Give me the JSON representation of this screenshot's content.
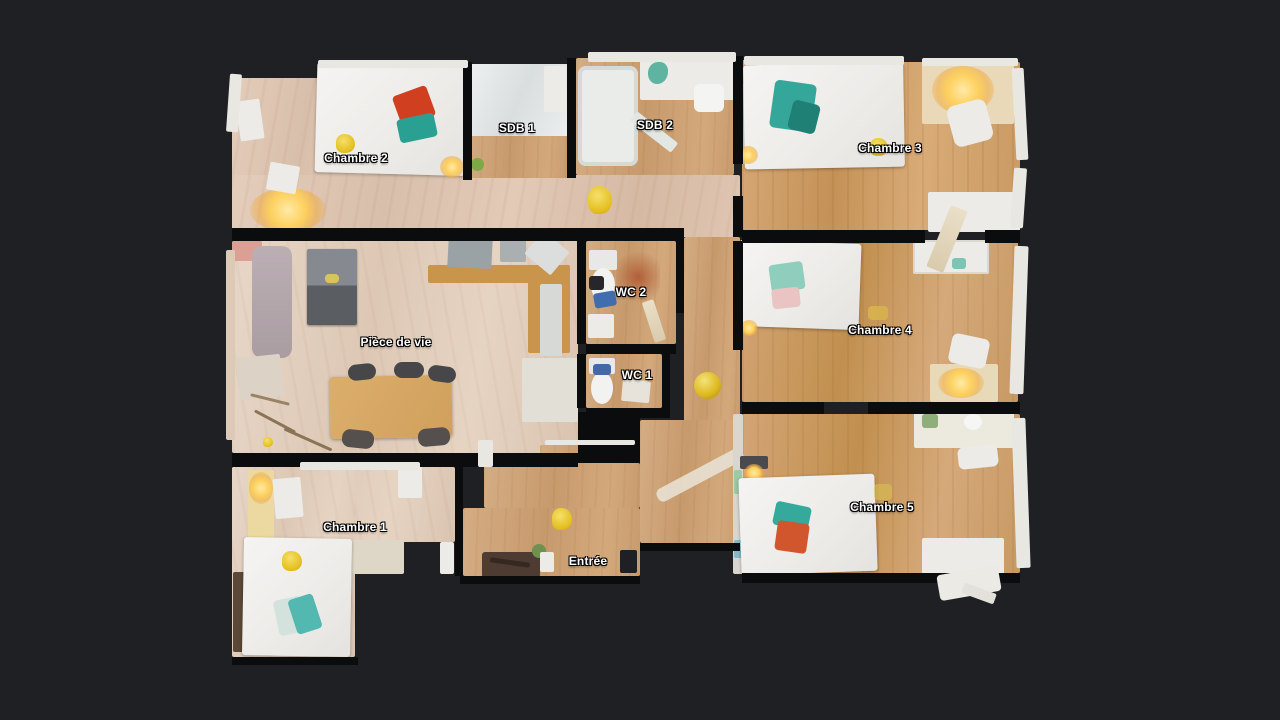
{
  "view": {
    "name": "floorplan-top-view"
  },
  "rooms": [
    {
      "id": "chambre-2",
      "label": "Chambre 2"
    },
    {
      "id": "sdb-1",
      "label": "SDB 1"
    },
    {
      "id": "sdb-2",
      "label": "SDB 2"
    },
    {
      "id": "chambre-3",
      "label": "Chambre 3"
    },
    {
      "id": "piece-de-vie",
      "label": "Pièce de vie"
    },
    {
      "id": "wc-2",
      "label": "WC 2"
    },
    {
      "id": "wc-1",
      "label": "WC 1"
    },
    {
      "id": "chambre-4",
      "label": "Chambre 4"
    },
    {
      "id": "chambre-1",
      "label": "Chambre 1"
    },
    {
      "id": "entree",
      "label": "Entrée"
    },
    {
      "id": "chambre-5",
      "label": "Chambre 5"
    }
  ],
  "colors": {
    "background": "#1f2023",
    "wall": "#0b0c0e",
    "label_text": "#ffffff",
    "label_outline": "#000000",
    "floor_light": "#e0c9b6",
    "floor_warm": "#cf9f6b",
    "bed_white": "#f1f0ee",
    "accent_teal": "#35a99c",
    "accent_red": "#d04020",
    "accent_pink": "#eac3c3",
    "accent_yellow": "#eac832",
    "lamp_glow": "#ffd35f"
  }
}
